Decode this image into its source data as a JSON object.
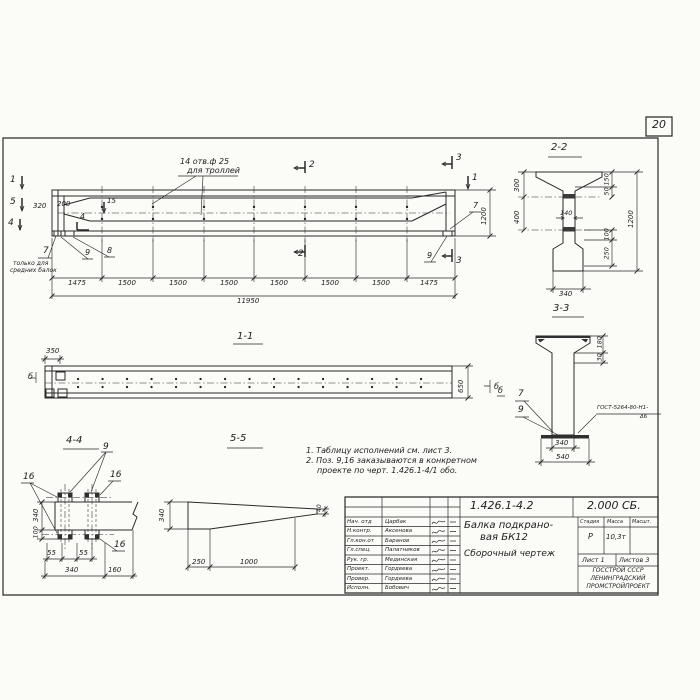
{
  "page_number": "20",
  "main_view": {
    "holes_note_line1": "14 отв.ф 25",
    "holes_note_line2": "для троллей",
    "cut_1_left": "1",
    "cut_5_left": "5",
    "cut_4_left": "4",
    "cut_1_right": "1",
    "cut_2_top": "2",
    "cut_2_bottom": "2",
    "cut_3_top": "3",
    "cut_3_bottom": "3",
    "dim_320": "320",
    "dim_200": "200",
    "dim_15": "15",
    "dim_1200": "1200",
    "pos_4": "4",
    "pos_7_right": "7",
    "pos_9_right": "9",
    "pos_9_left": "9",
    "pos_8_left": "8",
    "end_note_num": "7",
    "end_note_line1": "только для",
    "end_note_line2": "средних балок",
    "chain": [
      "1475",
      "1500",
      "1500",
      "1500",
      "1500",
      "1500",
      "1500",
      "1475"
    ],
    "total_length": "11950"
  },
  "section_1_1": {
    "title": "1-1",
    "dim_350": "350",
    "dim_650": "650",
    "mark_left": "б",
    "mark_right": "б"
  },
  "section_2_2": {
    "title": "2-2",
    "dim_300": "300",
    "dim_400": "400",
    "dim_150": "150",
    "dim_50": "50",
    "dim_140": "140",
    "dim_1200": "1200",
    "dim_100": "100",
    "dim_250": "250",
    "dim_340": "340"
  },
  "section_3_3": {
    "title": "3-3",
    "dim_180": "180",
    "dim_30": "30",
    "dim_340": "340",
    "dim_540": "540",
    "pos_7": "7",
    "pos_9": "9",
    "mark_b": "б",
    "weld_line1": "ГОСТ-5264-80-Н1-",
    "weld_line2": "Δ6"
  },
  "section_4_4": {
    "title": "4-4",
    "pos_9": "9",
    "pos_16_left": "16",
    "pos_16_top": "16",
    "pos_16_bottom": "16",
    "dim_340_v": "340",
    "dim_100": "100",
    "dim_55_a": "55",
    "dim_55_b": "55",
    "dim_340_b": "340",
    "dim_160": "160"
  },
  "section_5_5": {
    "title": "5-5",
    "dim_340": "340",
    "dim_40": "40",
    "dim_250": "250",
    "dim_1000": "1000"
  },
  "notes": {
    "line1": "1. Таблицу исполнений см. лист 3.",
    "line2": "2. Поз. 9,16 заказываются в конкретном",
    "line3": "проекте по черт. 1.426.1-4/1 обо."
  },
  "title_block": {
    "doc_number": "1.426.1-4.2",
    "doc_code": "2.000 СБ.",
    "product_line1": "Балка подкрано-",
    "product_line2": "вая БК12",
    "doc_type": "Сборочный чертеж",
    "rows": [
      {
        "role": "Нач. отд",
        "name": "Царбак"
      },
      {
        "role": "Н.контр.",
        "name": "Аксенова"
      },
      {
        "role": "Гл.кон.от",
        "name": "Баранов"
      },
      {
        "role": "Гл.спец.",
        "name": "Палатников"
      },
      {
        "role": "Рук. гр.",
        "name": "Мединская"
      },
      {
        "role": "Проект.",
        "name": "Гордеева"
      },
      {
        "role": "Провер.",
        "name": "Гордеева"
      },
      {
        "role": "Исполн.",
        "name": "Бобович"
      }
    ],
    "col_stage": "Стадия",
    "col_mass": "Масса",
    "col_scale": "Масшт.",
    "val_stage": "Р",
    "val_mass": "10,3т",
    "sheet": "Лист 1",
    "sheets": "Листов 3",
    "org_line1": "ГОССТРОЙ СССР",
    "org_line2": "ЛЕНИНГРАДСКИЙ",
    "org_line3": "ПРОМСТРОЙПРОЕКТ"
  }
}
